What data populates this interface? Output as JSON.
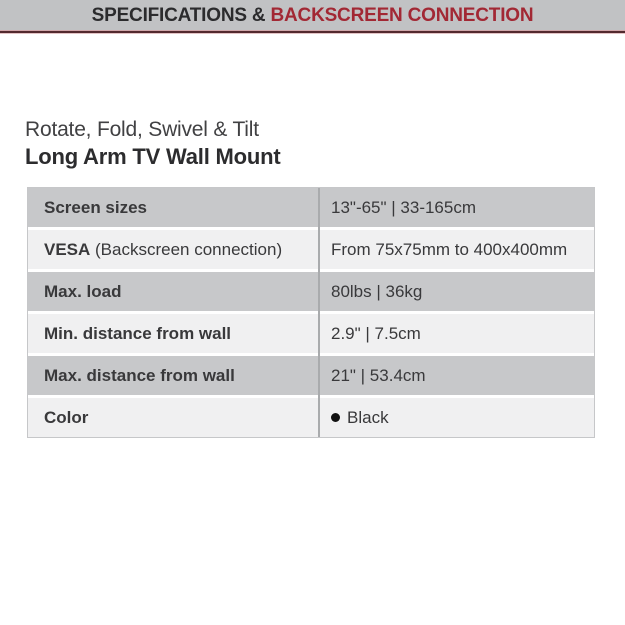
{
  "header": {
    "prefix": "SPECIFICATIONS & ",
    "highlight": "BACKSCREEN CONNECTION"
  },
  "product": {
    "subtitle": "Rotate, Fold, Swivel & Tilt",
    "title": "Long Arm TV Wall Mount"
  },
  "spec_table": {
    "rows": [
      {
        "label_strong": "Screen sizes",
        "value": "13\"-65\" | 33-165cm"
      },
      {
        "label_strong": "VESA",
        "label_normal": " (Backscreen connection)",
        "value": "From 75x75mm to 400x400mm"
      },
      {
        "label_strong": "Max. load",
        "value": "80lbs | 36kg"
      },
      {
        "label_strong": "Min. distance from wall",
        "value": "2.9\" | 7.5cm"
      },
      {
        "label_strong": "Max. distance from wall",
        "value": "21\" | 53.4cm"
      },
      {
        "label_strong": "Color",
        "value": "Black",
        "swatch_icon": "black-dot"
      }
    ]
  },
  "colors": {
    "header_bar_bg": "#c1c2c4",
    "header_text": "#2b2b2d",
    "header_highlight": "#a22834",
    "header_underline": "#53292e",
    "row_dark_bg": "#c7c8ca",
    "row_light_bg": "#f0f0f1",
    "column_divider": "#a9abad",
    "table_text": "#39393b",
    "swatch_black": "#111111"
  }
}
